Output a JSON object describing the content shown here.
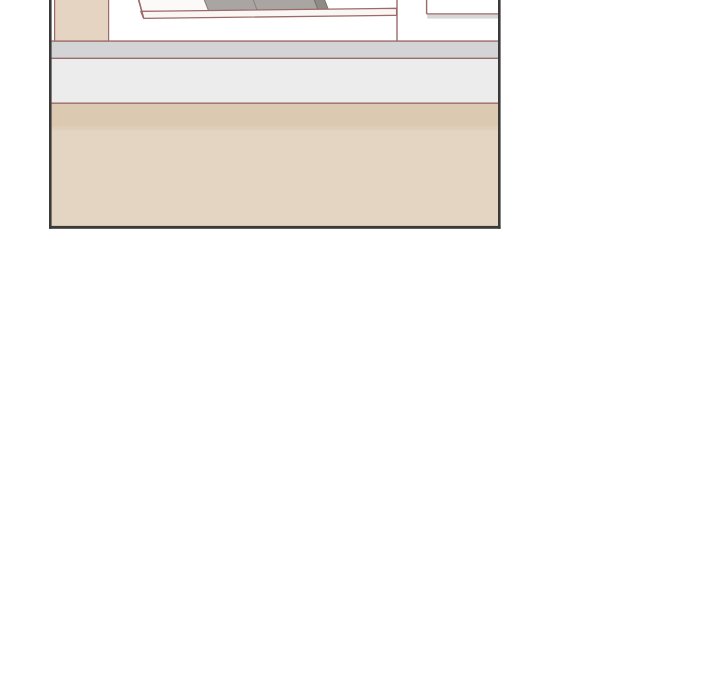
{
  "canvas": {
    "width": 720,
    "height": 700,
    "background_color": "#ffffff"
  },
  "palette": {
    "panel_border": "#3b3a39",
    "line_brown": "#9c6a69",
    "sideboard_beige": "#e6d4c3",
    "wall_band_gray": "#d4d3d6",
    "wall_band_light_gray": "#ebeceb",
    "floor_dark_beige": "#dbc9b2",
    "floor_transition_beige": "#dfcfba",
    "floor_light_beige": "#e4d5c2",
    "book_white": "#fcfaf8",
    "book_gray": "#a8a5a2",
    "book_dark_gray": "#8e8b87",
    "shelf_face_white": "#faf6f4",
    "shelf_underside_gray": "#d8d7d6"
  },
  "panel": {
    "x": 49,
    "y": 0,
    "width": 452,
    "height": 230,
    "viewBox": "0 0 452 230",
    "elements": [
      {
        "name": "panel-interior-background",
        "type": "rect",
        "attrs": {
          "x": 2.6,
          "y": 0,
          "width": 446.4,
          "height": 226,
          "fill": "#ffffff"
        }
      },
      {
        "name": "wall-band-upper-gray",
        "type": "rect",
        "attrs": {
          "x": 2.6,
          "y": 41,
          "width": 446.4,
          "height": 17.5,
          "fill": "#d4d3d6"
        }
      },
      {
        "name": "wall-band-lower-light-gray",
        "type": "rect",
        "attrs": {
          "x": 2.6,
          "y": 58.5,
          "width": 446.4,
          "height": 45,
          "fill": "#ebeceb"
        }
      },
      {
        "name": "floor-band-dark-beige",
        "type": "rect",
        "attrs": {
          "x": 2.6,
          "y": 103.5,
          "width": 446.4,
          "height": 23,
          "fill": "#dbc9b2"
        }
      },
      {
        "name": "floor-band-transition",
        "type": "rect",
        "attrs": {
          "x": 2.6,
          "y": 126.5,
          "width": 446.4,
          "height": 4,
          "fill": "#dfcfba"
        }
      },
      {
        "name": "floor-band-light-beige",
        "type": "rect",
        "attrs": {
          "x": 2.6,
          "y": 130.5,
          "width": 446.4,
          "height": 95.5,
          "fill": "#e4d5c2"
        }
      },
      {
        "name": "counter-top-line",
        "type": "line",
        "attrs": {
          "x1": 2.6,
          "y1": 41.1,
          "x2": 449,
          "y2": 41.1,
          "stroke": "#9c6a69",
          "stroke-width": 1.4
        }
      },
      {
        "name": "counter-bottom-line",
        "type": "line",
        "attrs": {
          "x1": 2.6,
          "y1": 58.3,
          "x2": 449,
          "y2": 58.3,
          "stroke": "#9c6a69",
          "stroke-width": 1.4
        }
      },
      {
        "name": "floor-edge-line",
        "type": "line",
        "attrs": {
          "x1": 2.6,
          "y1": 103.2,
          "x2": 449,
          "y2": 103.2,
          "stroke": "#9c6a69",
          "stroke-width": 1.4
        }
      },
      {
        "name": "sideboard-panel",
        "type": "rect",
        "attrs": {
          "x": 5.6,
          "y": -1,
          "width": 54,
          "height": 42,
          "fill": "#e6d4c3",
          "stroke": "#9c6a69",
          "stroke-width": 1.2
        }
      },
      {
        "name": "book-white",
        "type": "polygon",
        "attrs": {
          "points": "88.9,-2 154.6,-2 159.9,11.3 92.6,11.3",
          "fill": "#fcfaf8",
          "stroke": "#9c6a69",
          "stroke-width": 1.2
        }
      },
      {
        "name": "book-gray-1",
        "type": "polygon",
        "attrs": {
          "points": "154.6,-2 203.6,-2 208.6,11.3 159.9,11.3",
          "fill": "#a8a5a2",
          "stroke": "#8b8179",
          "stroke-width": 0.9
        }
      },
      {
        "name": "book-gray-2",
        "type": "polygon",
        "attrs": {
          "points": "203.6,-2 264.6,-2 269.6,11.3 208.6,11.3",
          "fill": "#a8a5a2",
          "stroke": "#8b8179",
          "stroke-width": 0.9
        }
      },
      {
        "name": "book-dark-gray",
        "type": "polygon",
        "attrs": {
          "points": "264.6,-2 274.9,-2 280.1,11.3 269.6,11.3",
          "fill": "#8e8b87",
          "stroke": "#746f68",
          "stroke-width": 0.9
        }
      },
      {
        "name": "shelf-front-edge",
        "type": "polygon",
        "attrs": {
          "points": "91.8,11.4 347.6,8.3 347.6,15.3 94.6,18.4",
          "fill": "#faf6f4",
          "stroke": "#9c6a69",
          "stroke-width": 1.3,
          "stroke-linejoin": "round"
        }
      },
      {
        "name": "leaning-book-spine-line",
        "type": "line",
        "attrs": {
          "x1": 89.6,
          "y1": -1,
          "x2": 94.7,
          "y2": 18.2,
          "stroke": "#9c6a69",
          "stroke-width": 1.4
        }
      },
      {
        "name": "shelf-side-vertical-line",
        "type": "line",
        "attrs": {
          "x1": 348,
          "y1": -1,
          "x2": 348,
          "y2": 41.3,
          "stroke": "#9c6a69",
          "stroke-width": 1.4
        }
      },
      {
        "name": "right-unit-corner-line",
        "type": "line",
        "attrs": {
          "x1": 377.6,
          "y1": -1,
          "x2": 377.6,
          "y2": 13.9,
          "stroke": "#9c6a69",
          "stroke-width": 1.4
        }
      },
      {
        "name": "right-shelf-top-line",
        "type": "line",
        "attrs": {
          "x1": 377.6,
          "y1": 13.9,
          "x2": 449,
          "y2": 13.9,
          "stroke": "#9c6a69",
          "stroke-width": 1.4
        }
      },
      {
        "name": "right-shelf-underside",
        "type": "rect",
        "attrs": {
          "x": 378.2,
          "y": 14.6,
          "width": 70.8,
          "height": 4,
          "fill": "#d8d7d6"
        }
      },
      {
        "name": "panel-border-left",
        "type": "rect",
        "attrs": {
          "x": 0,
          "y": -1,
          "width": 2.6,
          "height": 229.8,
          "fill": "#3b3a39"
        }
      },
      {
        "name": "panel-border-right",
        "type": "rect",
        "attrs": {
          "x": 449,
          "y": -1,
          "width": 2.6,
          "height": 229.8,
          "fill": "#3b3a39"
        }
      },
      {
        "name": "panel-border-bottom",
        "type": "rect",
        "attrs": {
          "x": 0,
          "y": 225.9,
          "width": 451.6,
          "height": 2.9,
          "fill": "#3b3a39"
        }
      }
    ]
  }
}
